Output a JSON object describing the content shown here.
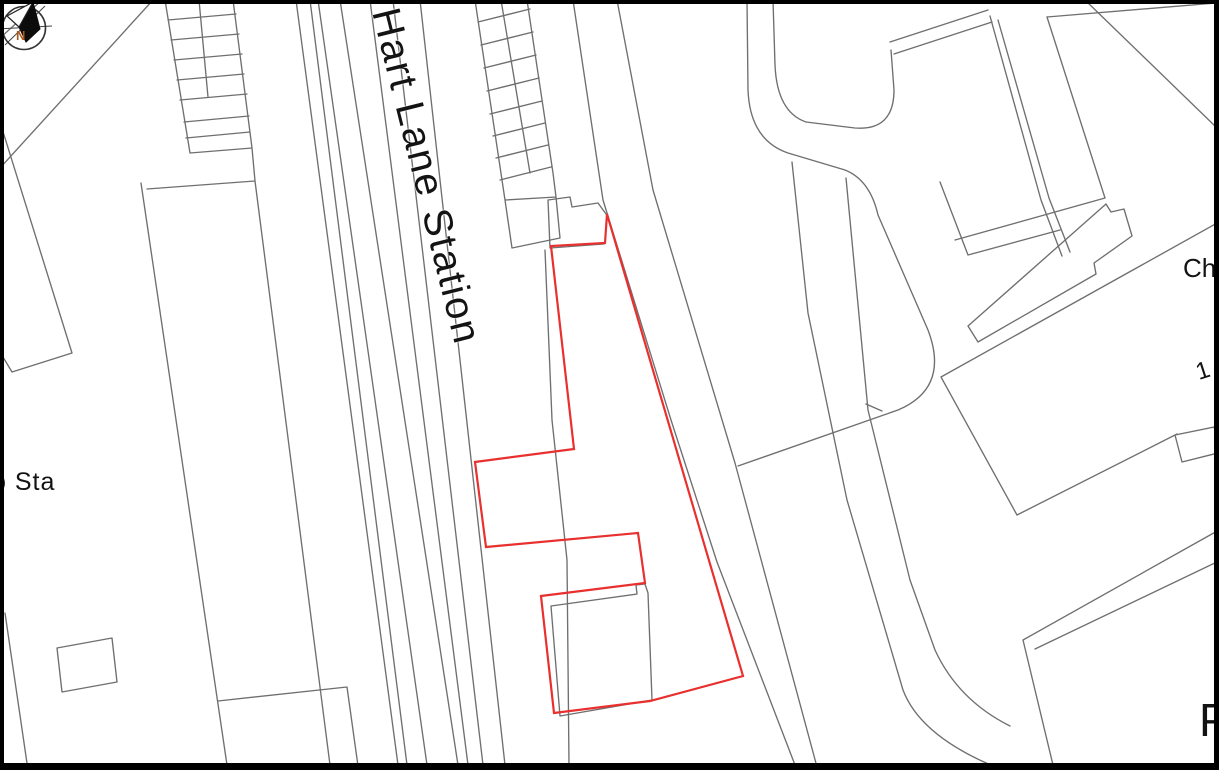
{
  "map": {
    "labels": {
      "station": "Hart Lane Station",
      "substation_partial": "b Sta",
      "cha_partial": "Cha",
      "house_numbers_partial": "1 t",
      "p_partial": "P",
      "compass_north": "N"
    },
    "colors": {
      "site_boundary": "#e8302e",
      "map_line": "#6f6f6f",
      "text": "#131313",
      "compass_north_text": "#a8571d",
      "frame": "#000000",
      "background": "#ffffff"
    },
    "site_boundary": {
      "points": "607,214 605,243 551,246 574,449 475,462 486,547 638,533 645,583 541,596 554,713 650,701 743,676"
    },
    "gray_paths": [
      {
        "name": "corner-cut-line",
        "d": "M42,0 L0,38"
      },
      {
        "name": "parcel-line-topleft",
        "d": "M153,0 L0,168"
      },
      {
        "name": "wedge-parcel",
        "d": "M0,122 L72,353 L12,372 L0,352"
      },
      {
        "name": "bottomleft-line",
        "d": "M5,613 L28,770"
      },
      {
        "name": "bottomleft-outbuilding",
        "d": "M57,648 L112,638 L117,682 L62,692 Z"
      },
      {
        "name": "terrace-row",
        "d": "M165,0 L190,153 L252,148 L233,0 M199,0 L208,97 M168,20 L236,14 M171,40 L239,34 M174,60 L242,54 M177,80 L244,74 M180,100 L247,94 M184,122 L249,116 M186,138 L250,132"
      },
      {
        "name": "left-parcel-lines",
        "d": "M147,189 L255,181 L330,765 M252,148 L255,181 M141,183 L227,765"
      },
      {
        "name": "bottom-parcel-lines",
        "d": "M218,701 L347,687 L358,766"
      },
      {
        "name": "railway-lines",
        "d": "M296,0 L398,765 M310,0 L407,765 M318,0 L427,765 M340,0 L458,765 M370,0 L468,765 M393,0 L483,765 M420,0 L505,765"
      },
      {
        "name": "station-building-grid",
        "d": "M475,0 L505,200 L512,248 L560,238 L556,197 L553,173 L527,0 M501,0 L530,173 M505,200 L556,197 M478,22 L530,9 M481,45 L533,32 M484,68 L536,55 M487,91 L539,78 M490,114 L542,101 M493,136 L545,123 M496,158 L548,145 M500,180 L551,167"
      },
      {
        "name": "station-south-annex",
        "d": "M548,200 L570,197 L572,207 L598,203 L606,214 M548,200 L550,248 L604,244"
      },
      {
        "name": "platform-interior-line",
        "d": "M545,250 L552,420 L567,560 L569,765"
      },
      {
        "name": "road-west-edge",
        "d": "M573,0 L603,200 L671,420 L717,562 L795,765"
      },
      {
        "name": "road-east-edge",
        "d": "M617,0 L653,190 L735,463 L817,767"
      },
      {
        "name": "loop-road-outer",
        "d": "M747,0 L748,90 Q750,140 788,153 L845,170 Q870,180 878,215 L928,330 Q950,388 898,410 L738,466"
      },
      {
        "name": "loop-road-inner",
        "d": "M773,0 L775,65 Q777,112 806,122 L855,128 Q894,131 894,90 L891,50"
      },
      {
        "name": "northeast-wall-pair",
        "d": "M890,42 L988,10 M894,54 L992,22"
      },
      {
        "name": "east-road-edge-1",
        "d": "M792,162 Q800,240 808,313 L847,500 L903,690 Q920,735 993,766"
      },
      {
        "name": "east-road-edge-2",
        "d": "M846,178 L868,410 L910,580 L935,650 Q958,700 1010,726 M866,404 L882,411"
      },
      {
        "name": "northeast-path-pair",
        "d": "M990,16 L1041,200 L1062,256 M998,20 L1049,198 L1070,252"
      },
      {
        "name": "top-right-boundary",
        "d": "M1047,17 L1216,3"
      },
      {
        "name": "top-right-building-edge",
        "d": "M1085,0 L1216,127"
      },
      {
        "name": "east-parcel-line",
        "d": "M1047,17 L1105,198 L955,240"
      },
      {
        "name": "east-building-corner",
        "d": "M940,182 L968,255 L1060,230"
      },
      {
        "name": "terrace-strip-building",
        "d": "M968,326 L1106,204 L1111,212 L1124,209 L1132,236 L1094,263 L1096,274 L978,342 Z"
      },
      {
        "name": "large-east-building",
        "d": "M941,377 L1219,222 M941,377 L1017,515 L1177,434 M1175,435 L1214,427 L1222,452 L1182,462 Z"
      },
      {
        "name": "southeast-wall-lines",
        "d": "M1023,640 L1219,530 M1035,649 L1219,561 M1023,640 L1053,765"
      },
      {
        "name": "site-building-echo",
        "d": "M551,606 L637,594 L636,585 L645,584 L648,593 L652,700 L560,716 Z"
      }
    ]
  }
}
